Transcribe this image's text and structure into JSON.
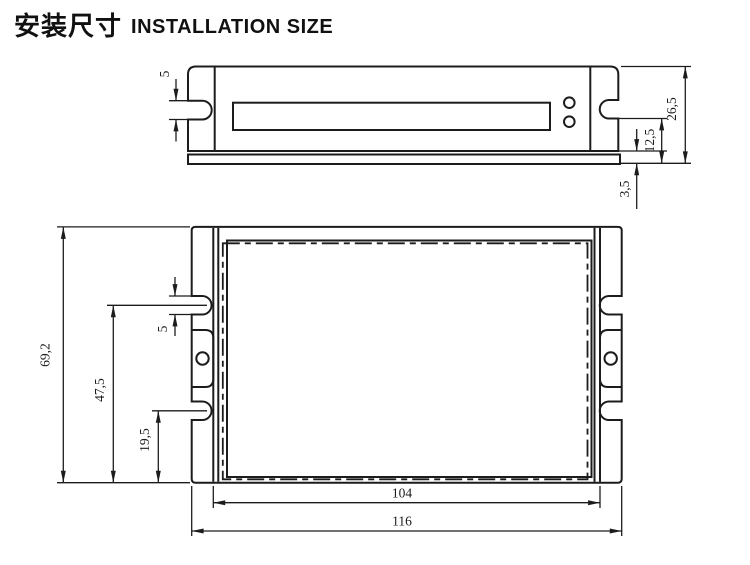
{
  "title": {
    "zh": "安装尺寸",
    "en": "INSTALLATION SIZE"
  },
  "colors": {
    "line": "#1c1c1c",
    "background": "#ffffff"
  },
  "side_view": {
    "description": "side elevation of driver enclosure with mounting tabs, terminal slot, two LED holes and base plate",
    "dims": {
      "slot_width": "5",
      "overall_height": "26,5",
      "mount_step_height": "12,5",
      "base_thickness": "3,5"
    }
  },
  "top_view": {
    "description": "plan view of enclosure with mounting slots, center screw holes and hidden base edge",
    "dims": {
      "overall_depth": "69,2",
      "slot_center_span": "47,5",
      "lower_slot_offset": "19,5",
      "slot_width": "5",
      "mount_span": "104",
      "overall_width": "116"
    }
  }
}
